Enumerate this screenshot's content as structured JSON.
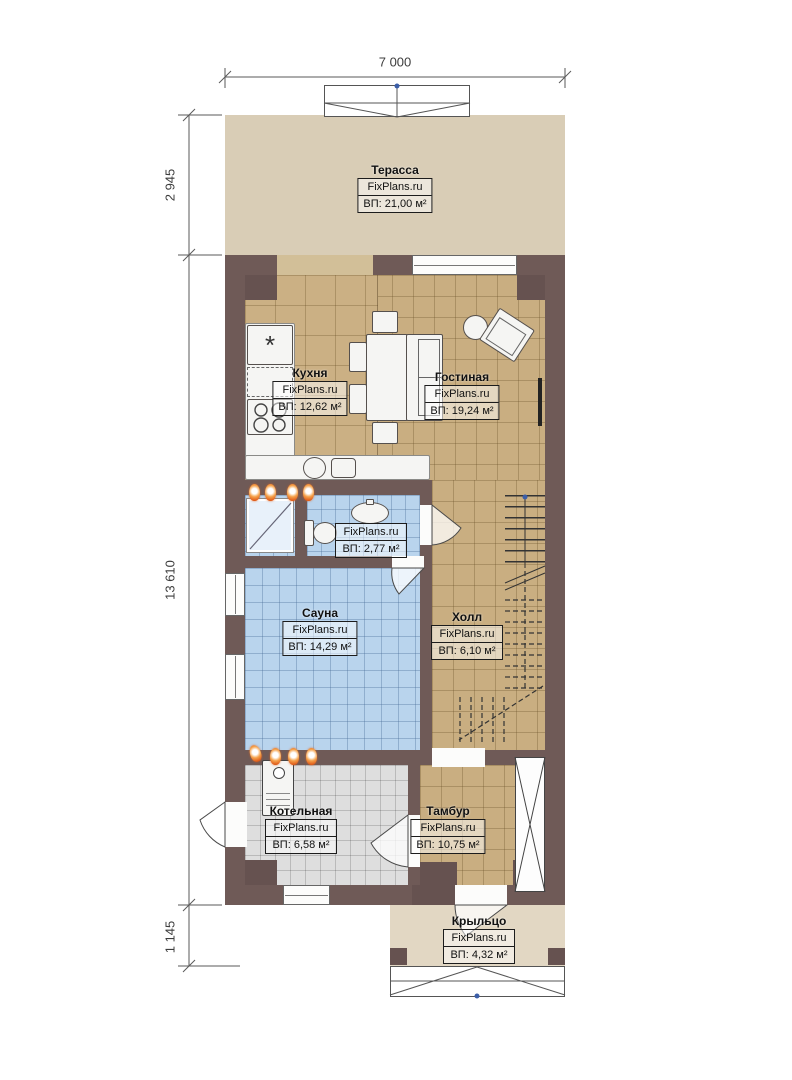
{
  "brand": "FixPlans.ru",
  "dimensions": {
    "width_top": "7 000",
    "terrace_depth": "2 945",
    "house_length": "13 610",
    "porch_depth": "1 145"
  },
  "rooms": {
    "terrace": {
      "name": "Терасса",
      "area": "ВП: 21,00 м²"
    },
    "kitchen": {
      "name": "Кухня",
      "area": "ВП: 12,62 м²"
    },
    "living": {
      "name": "Гостиная",
      "area": "ВП: 19,24 м²"
    },
    "bathroom": {
      "name": "",
      "area": "ВП: 2,77 м²"
    },
    "sauna": {
      "name": "Сауна",
      "area": "ВП: 14,29 м²"
    },
    "hall": {
      "name": "Холл",
      "area": "ВП: 6,10 м²"
    },
    "boiler": {
      "name": "Котельная",
      "area": "ВП: 6,58 м²"
    },
    "vestibule": {
      "name": "Тамбур",
      "area": "ВП: 10,75 м²"
    },
    "porch": {
      "name": "Крыльцо",
      "area": "ВП: 4,32 м²"
    }
  },
  "colors": {
    "wall": "#6f5a57",
    "floor_wood": "#c9ae81",
    "floor_wet": "#b9d4ed",
    "floor_tech": "#dedede",
    "terrace": "#d9cdb6",
    "radiator": "#e2611d"
  }
}
